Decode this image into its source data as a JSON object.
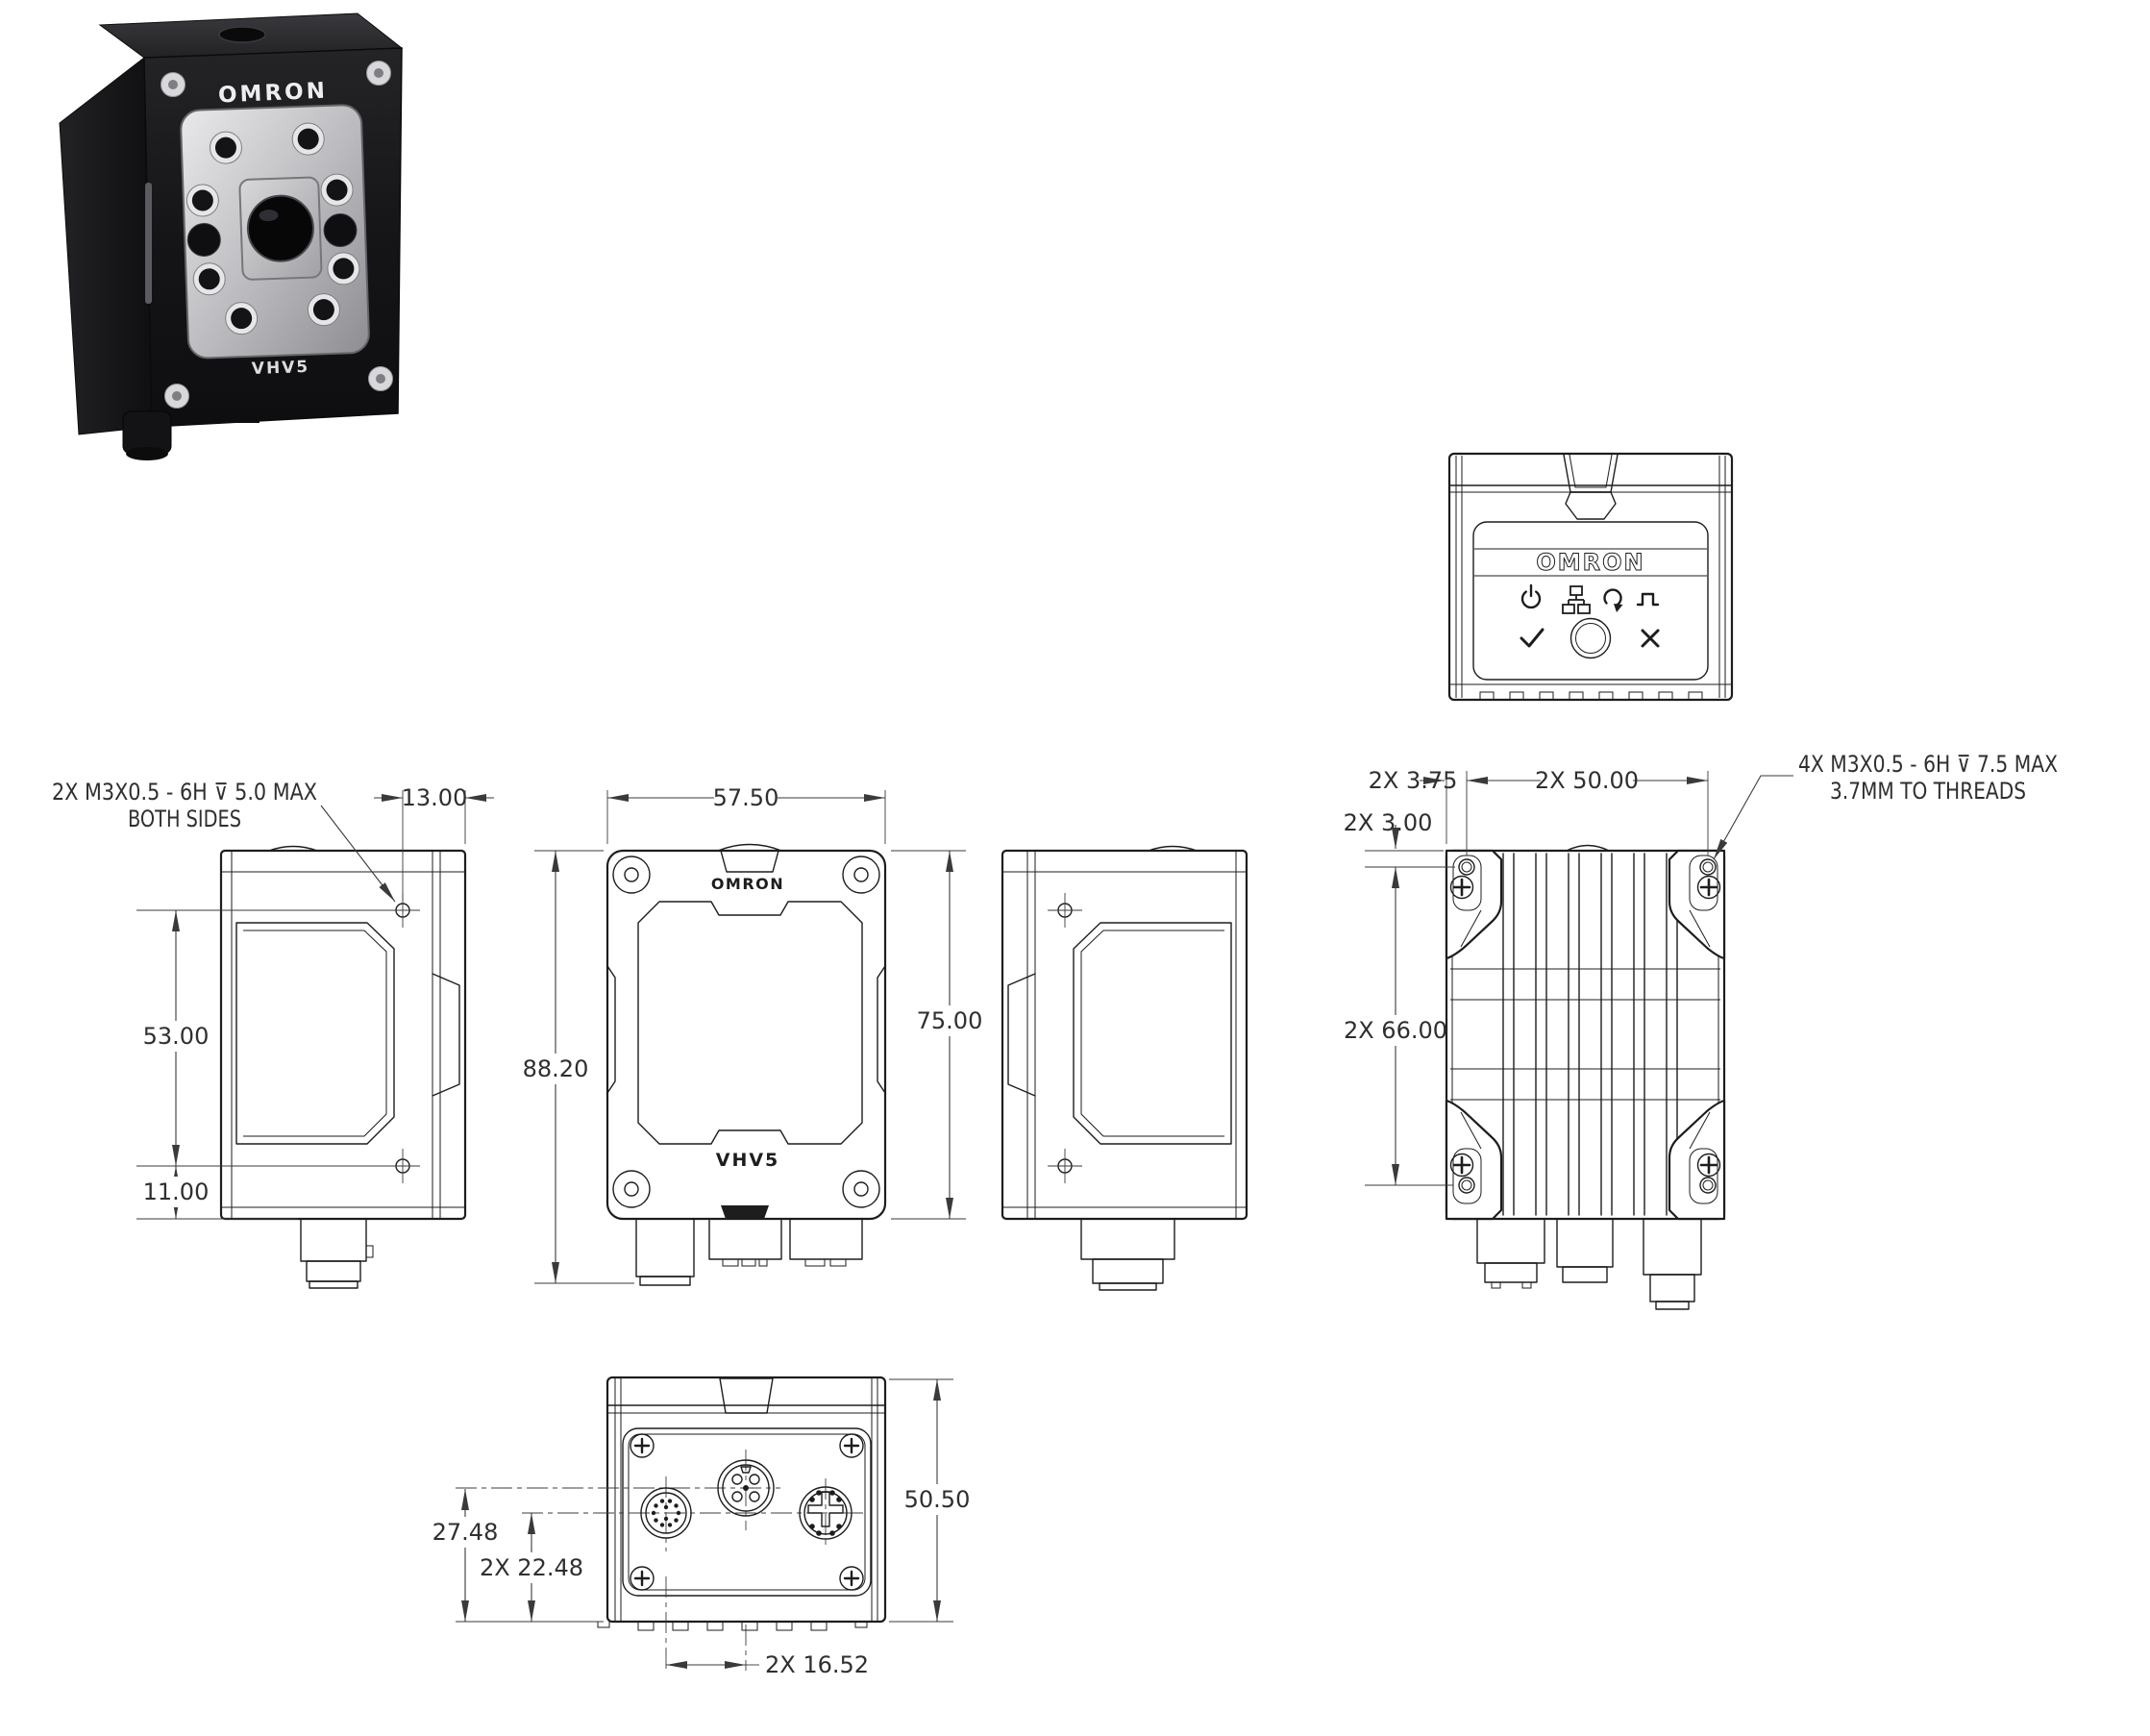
{
  "page": {
    "background": "#ffffff",
    "line_color": "#1d1d1d",
    "dim_color": "#3a3a3a"
  },
  "product": {
    "brand": "OMRON",
    "model": "VHV5"
  },
  "photo": {
    "brand_label": "OMRON",
    "model_label": "VHV5"
  },
  "views": {
    "top_panel": {
      "brand_label": "OMRON",
      "icons": [
        {
          "name": "power-icon"
        },
        {
          "name": "ethernet-icon"
        },
        {
          "name": "link-active-icon"
        },
        {
          "name": "trigger-icon"
        },
        {
          "name": "pass-check-icon"
        },
        {
          "name": "select-button"
        },
        {
          "name": "fail-x-icon"
        }
      ]
    },
    "side_left": {
      "annotation": {
        "line1": "2X M3X0.5 - 6H ⊽ 5.0 MAX",
        "line2": "BOTH SIDES"
      },
      "dims": {
        "hole_offset": "13.00",
        "hole_spacing": "53.00",
        "hole_to_bottom": "11.00"
      }
    },
    "front": {
      "brand_label": "OMRON",
      "model_label": "VHV5",
      "dims": {
        "width": "57.50",
        "overall_height": "88.20",
        "body_height": "75.00"
      }
    },
    "rear": {
      "annotation": {
        "line1": "4X M3X0.5 - 6H ⊽ 7.5 MAX",
        "line2": "3.7MM TO THREADS"
      },
      "dims": {
        "hole_edge_offset": "2X 3.75",
        "hole_spacing_width": "2X 50.00",
        "hole_top_offset": "2X 3.00",
        "hole_spacing_height": "2X 66.00"
      }
    },
    "bottom": {
      "dims": {
        "middle_connector_offset": "27.48",
        "outer_connector_offset": "2X 22.48",
        "depth": "50.50",
        "connector_pitch": "2X 16.52"
      }
    }
  }
}
